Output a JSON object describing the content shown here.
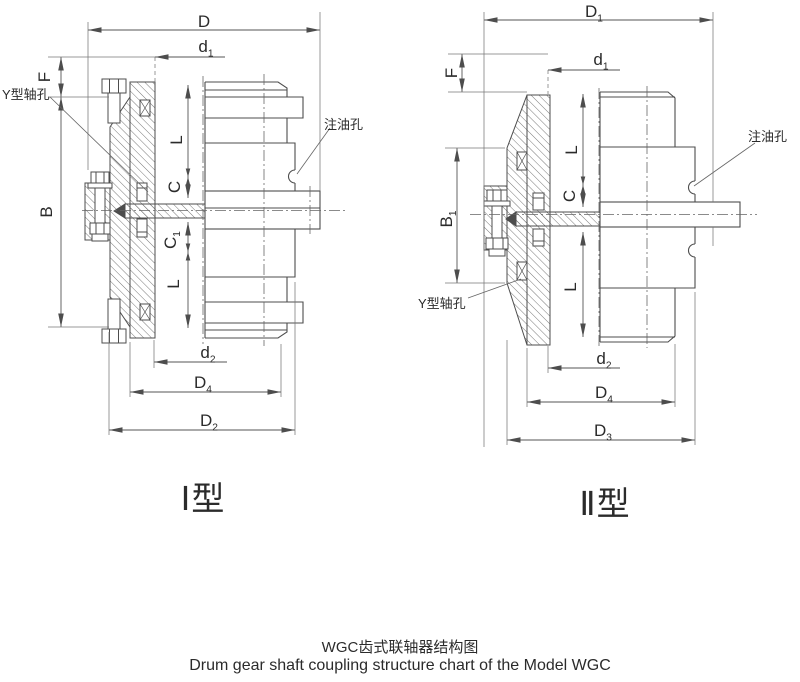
{
  "left": {
    "type_label": "Ⅰ型",
    "dim_D": "D",
    "dim_d1": {
      "base": "d",
      "sub": "1"
    },
    "dim_F": "F",
    "dim_B": "B",
    "dim_L_top": "L",
    "dim_C": "C",
    "dim_C1": {
      "base": "C",
      "sub": "1"
    },
    "dim_L_bottom": "L",
    "dim_d2": {
      "base": "d",
      "sub": "2"
    },
    "dim_D4": {
      "base": "D",
      "sub": "4"
    },
    "dim_D2": {
      "base": "D",
      "sub": "2"
    },
    "shaft_hole_label": "Y型轴孔",
    "oil_hole_label": "注油孔"
  },
  "right": {
    "type_label": "Ⅱ型",
    "dim_D1": {
      "base": "D",
      "sub": "1"
    },
    "dim_d1": {
      "base": "d",
      "sub": "1"
    },
    "dim_F": "F",
    "dim_B1": {
      "base": "B",
      "sub": "1"
    },
    "dim_L_top": "L",
    "dim_C": "C",
    "dim_L_bottom": "L",
    "dim_d2": {
      "base": "d",
      "sub": "2"
    },
    "dim_D4": {
      "base": "D",
      "sub": "4"
    },
    "dim_D3": {
      "base": "D",
      "sub": "3"
    },
    "shaft_hole_label": "Y型轴孔",
    "oil_hole_label": "注油孔"
  },
  "caption": {
    "title_zh": "WGC齿式联轴器结构图",
    "title_en": "Drum gear shaft coupling structure chart of the Model WGC"
  }
}
